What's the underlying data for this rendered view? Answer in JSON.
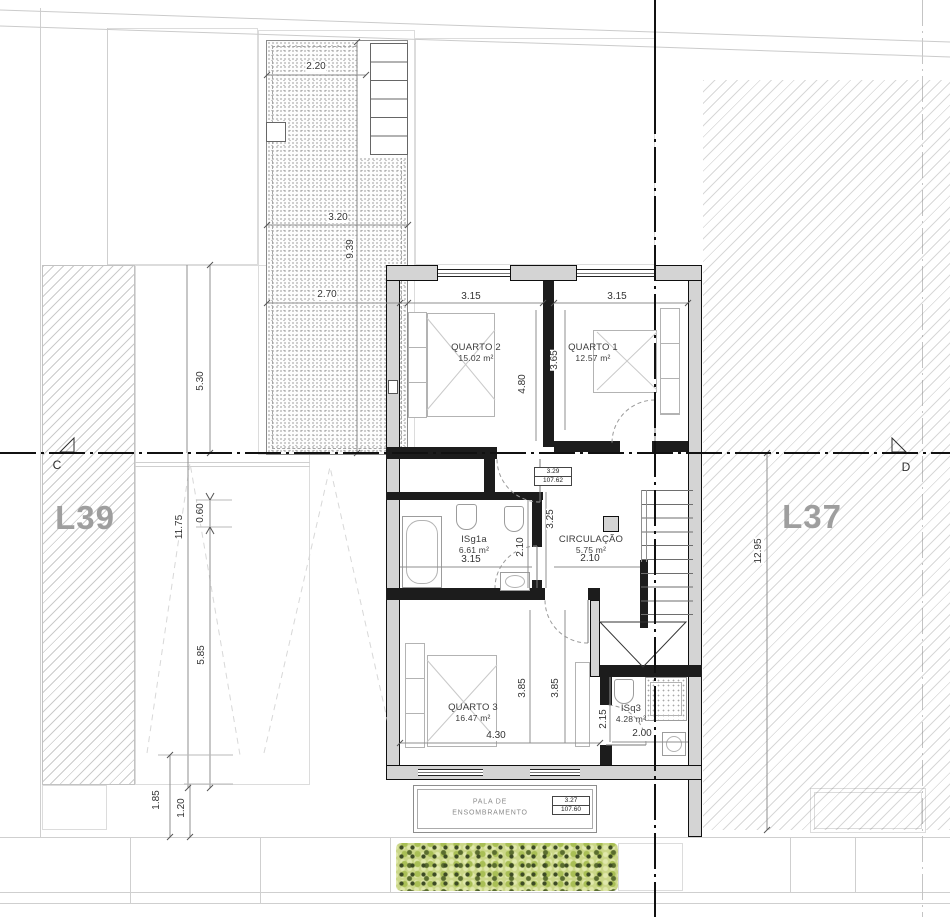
{
  "lots": {
    "left": "L39",
    "right": "L37"
  },
  "section_markers": {
    "left": "C",
    "right": "D"
  },
  "rooms": {
    "quarto2": {
      "name": "QUARTO 2",
      "area": "15.02 m²"
    },
    "quarto1": {
      "name": "QUARTO 1",
      "area": "12.57 m²"
    },
    "isg1a": {
      "name": "ISg1a",
      "area": "6.61 m²"
    },
    "circulacao": {
      "name": "CIRCULAÇÃO",
      "area": "5.75 m²"
    },
    "quarto3": {
      "name": "QUARTO 3",
      "area": "16.47 m²"
    },
    "isq3": {
      "name": "ISq3",
      "area": "4.28 m²"
    }
  },
  "canopy": {
    "line1": "PALA DE",
    "line2": "ENSOMBRAMENTO"
  },
  "levels": {
    "upper": {
      "height": "3.29",
      "elevation": "107.62"
    },
    "lower": {
      "height": "3.27",
      "elevation": "107.60"
    }
  },
  "dims": {
    "terrace_top": "2.20",
    "terrace_mid": "3.20",
    "terrace_len": "9.39",
    "terrace_low": "2.70",
    "left_upper": "5.30",
    "left_total": "11.75",
    "left_small": "0.60",
    "left_lower": "5.85",
    "left_b1": "1.85",
    "left_b2": "1.20",
    "right_total": "12.95",
    "q2_w": "3.15",
    "q2_d": "4.80",
    "q1_w": "3.15",
    "q1_d": "3.65",
    "isg1a_w": "3.15",
    "isg1a_d": "2.10",
    "circ_w": "2.10",
    "circ_d": "3.25",
    "q3_w": "4.30",
    "q3_d1": "3.85",
    "q3_d2": "3.85",
    "isq3_w": "2.00",
    "isq3_d": "2.15"
  },
  "colors": {
    "wall_fill": "#d4d4d4",
    "wall_stroke": "#0f0f0f",
    "hedge_light": "#cbd788",
    "hedge_dark": "#3c4a24",
    "lot_label": "#9e9e9e"
  }
}
